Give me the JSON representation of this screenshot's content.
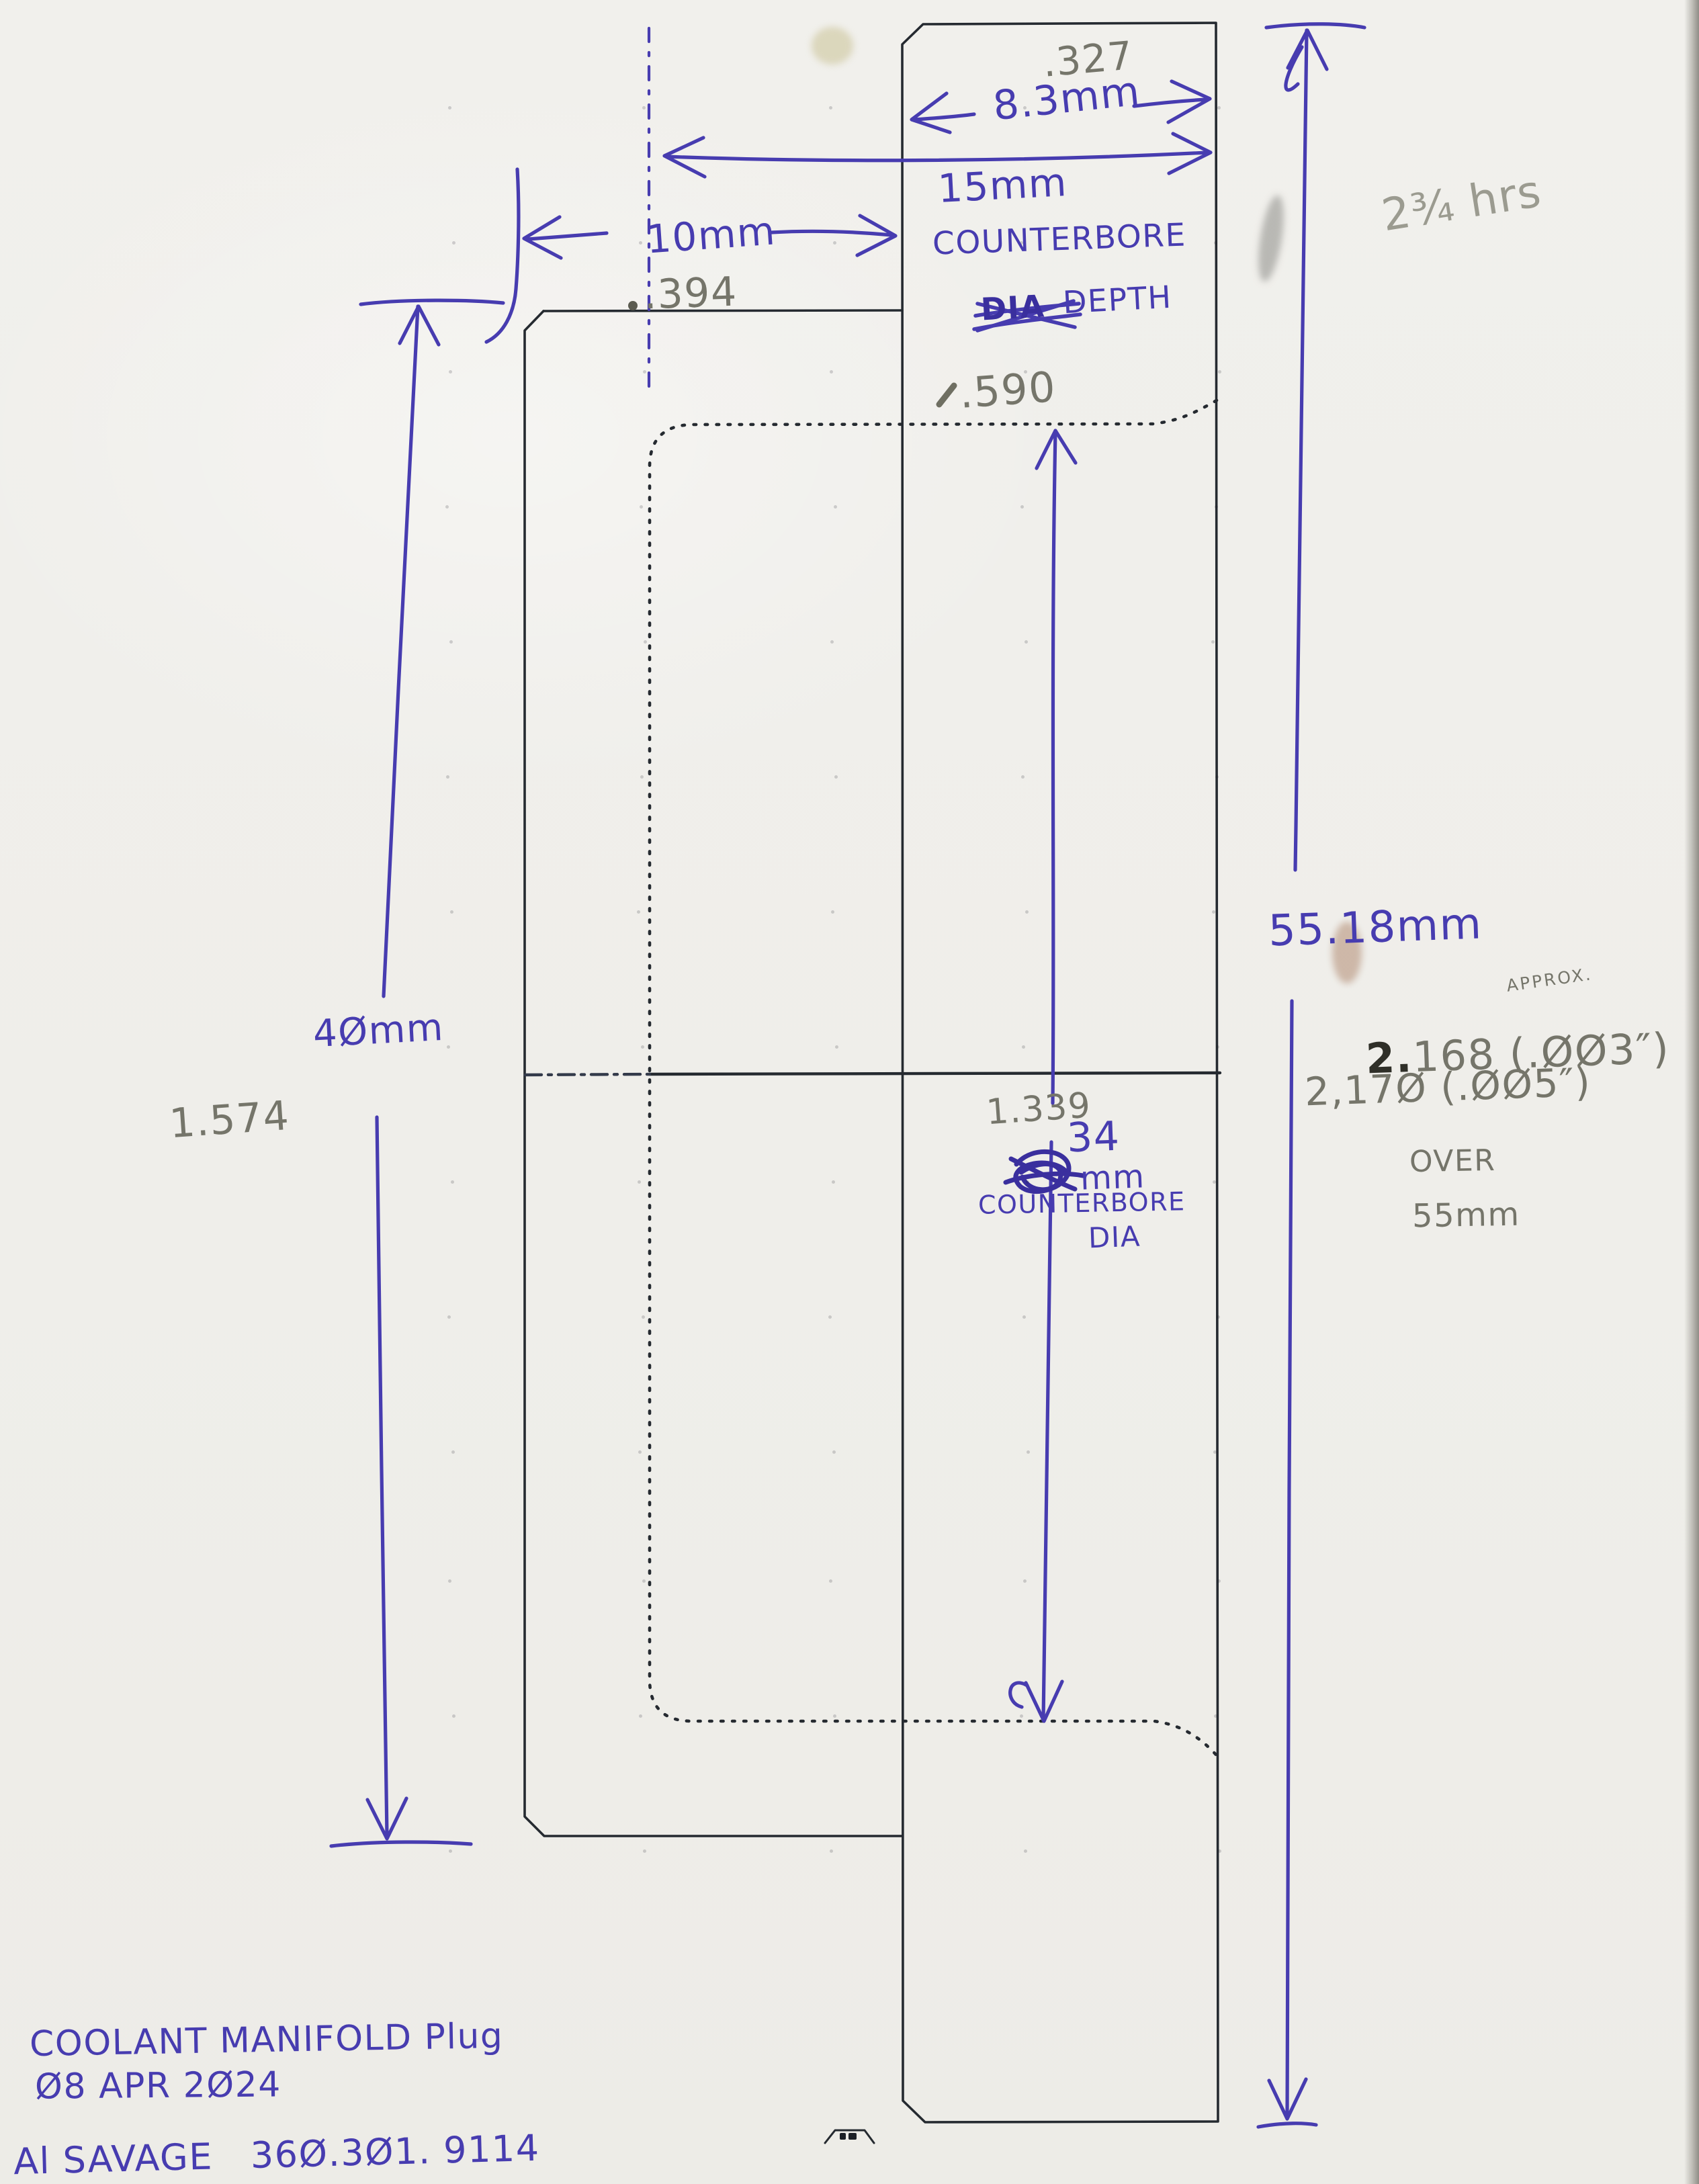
{
  "colors": {
    "pen_blue": "#473CB0",
    "pencil_gray": "#75756A",
    "drawing_line": "#252A30",
    "paper": "#F0EFEB"
  },
  "width_dim": {
    "inches": ".327",
    "mm": "8.3mm"
  },
  "counterbore_depth": {
    "mm": "15mm",
    "word1": "COUNTERBORE",
    "struck_word": "DIA",
    "word2": "DEPTH",
    "inches": ".590"
  },
  "offset_dim": {
    "mm": "10mm",
    "inches": ".394"
  },
  "body_length_dim": {
    "mm": "4Ømm",
    "inches": "1.574"
  },
  "overall_length_dim": {
    "mm": "55.18mm",
    "approx_note": "APPROX.",
    "reading1_prefix": "2.",
    "reading1_rest": "168 (.ØØ3″)",
    "reading2": "2,17Ø (.ØØ5″)",
    "over_word": "OVER",
    "over_value": "55mm"
  },
  "counterbore_dia": {
    "inches": "1.339",
    "mm": "34",
    "unit": "mm",
    "word1": "COUNTERBORE",
    "word2": "DIA"
  },
  "time_note": "2¾ hrs",
  "title_block": {
    "part_name": "COOLANT MANIFOLD Plug",
    "date": "Ø8 APR 2Ø24",
    "author_contact": "Al SAVAGE   36Ø.3Ø1. 9114"
  }
}
